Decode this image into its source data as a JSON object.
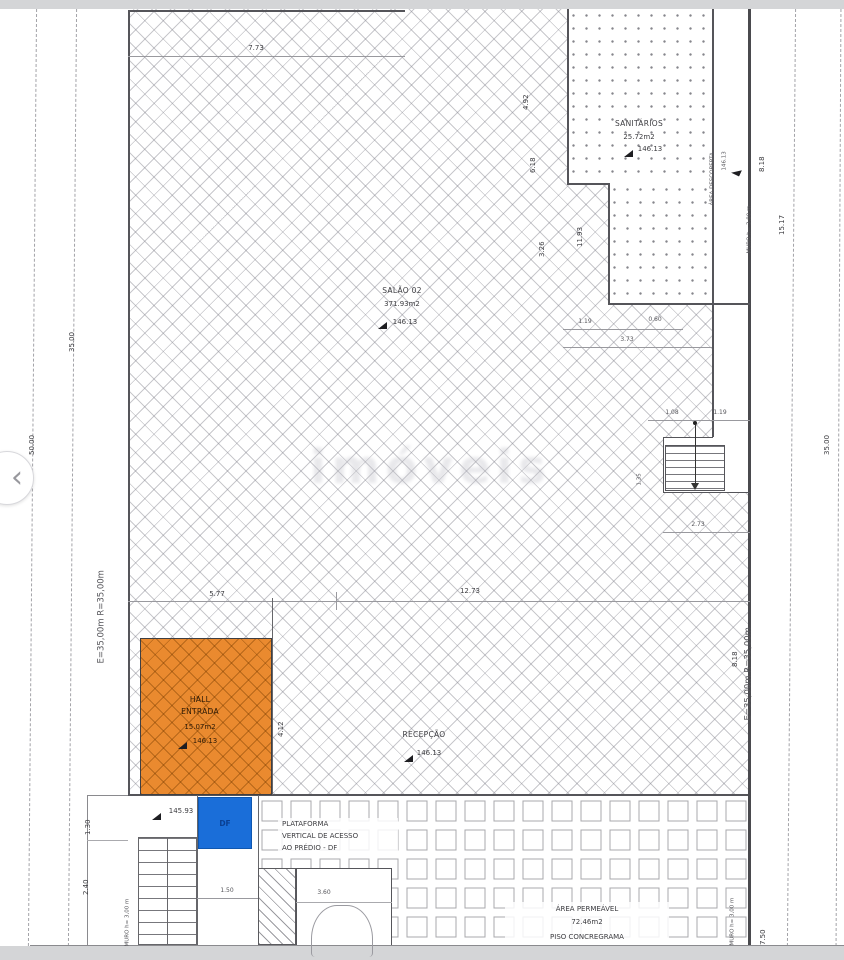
{
  "viewer": {
    "prev_label": "‹"
  },
  "watermark": "imóveis",
  "rooms": {
    "salao": {
      "name": "SALÃO 02",
      "area": "371.93m2",
      "level": "146.13"
    },
    "sanitarios": {
      "name": "SANITÁRIOS",
      "area": "25.72m2",
      "level": "146.13"
    },
    "descoberta": {
      "name": "ÁREA DESCOBERTA",
      "level": "146.13"
    },
    "hall": {
      "line1": "HALL",
      "line2": "ENTRADA",
      "area": "15.07m2",
      "level": "146.13"
    },
    "recepcao": {
      "name": "RECEPÇÃO",
      "level": "146.13"
    },
    "plataforma": {
      "line1": "PLATAFORMA",
      "line2": "VERTICAL DE ACESSO",
      "line3": "AO PRÉDIO - DF"
    },
    "df": {
      "label": "DF"
    },
    "permeavel": {
      "name": "ÁREA PERMEÁVEL",
      "area": "72.46m2",
      "piso": "PISO CONCREGRAMA"
    },
    "calcada_level": "145.93"
  },
  "boundary": {
    "left_e": "E=35,00m  R=35,00m",
    "right_e": "E=35,00m  R=35,00m",
    "muro": "MURO h= 3,00 m",
    "left_inner": "35.00",
    "left_outer": "50.00",
    "right_outer": "35.00"
  },
  "dims": {
    "w773": "7.73",
    "w492": "4.92",
    "w618": "6.18",
    "w326": "3.26",
    "w1193": "11.93",
    "w119a": "1.19",
    "w060": "0.60",
    "w373": "3.73",
    "w818a": "8.18",
    "w1517": "15.17",
    "w108": "1.08",
    "w119b": "1.19",
    "w135": "1.35",
    "w273": "2.73",
    "w577": "5.77",
    "w1273": "12.73",
    "w818b": "8.18",
    "w412": "4.12",
    "w130": "1.30",
    "w240": "2.40",
    "w150": "1.50",
    "w360": "3.60",
    "w750": "7.50"
  }
}
